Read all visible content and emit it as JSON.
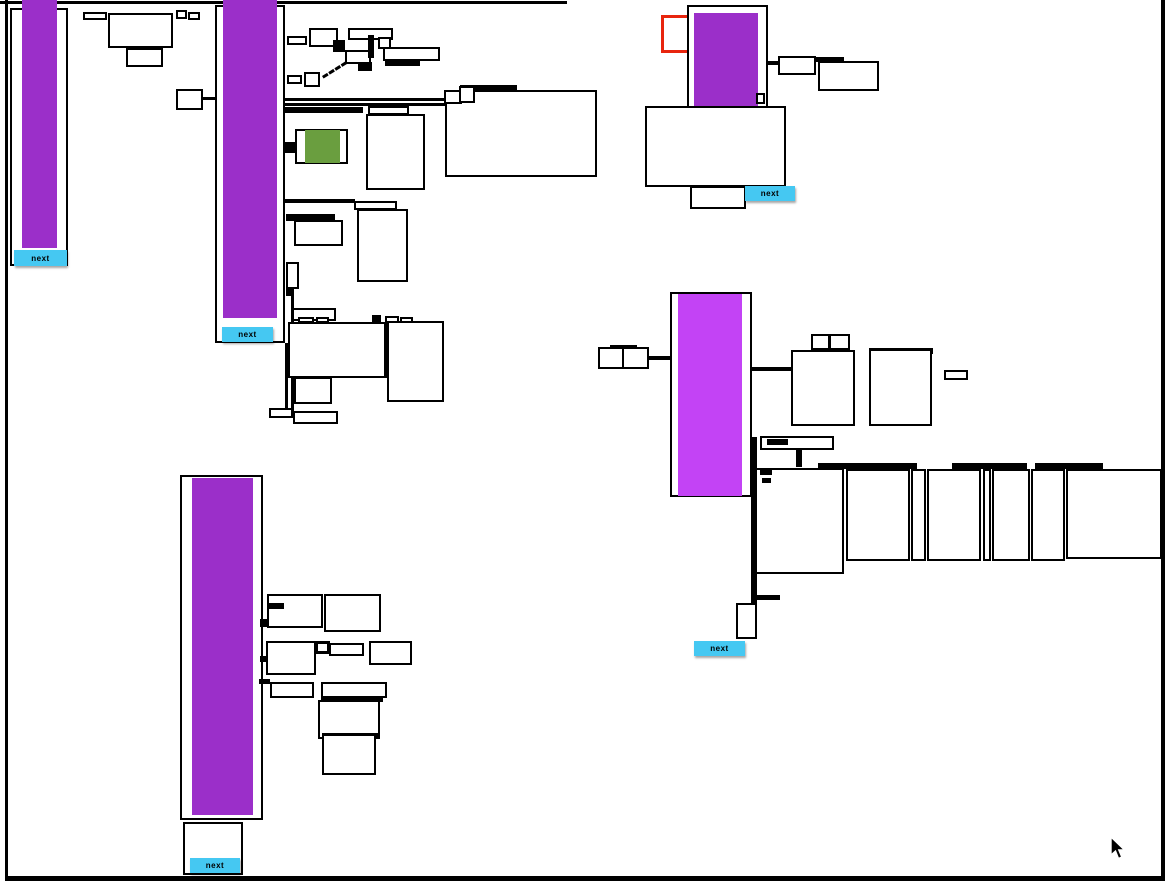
{
  "labels": {
    "next": "next"
  },
  "colors": {
    "purple": "#9b2fc9",
    "magenta": "#c343f5",
    "cyan": "#45c8f2",
    "green": "#6a9e3f",
    "red": "#e8250e",
    "black": "#000000",
    "background": "#ffffff"
  },
  "clusters": [
    {
      "id": "top-left-page",
      "highlight_color": "purple",
      "button": "next"
    },
    {
      "id": "top-middle-page",
      "highlight_color": "purple",
      "button": "next"
    },
    {
      "id": "top-right-page",
      "highlight_color": "purple",
      "button": "next",
      "selection_outline": "red"
    },
    {
      "id": "middle-right-page",
      "highlight_color": "magenta",
      "button": "next"
    },
    {
      "id": "bottom-left-page",
      "highlight_color": "purple",
      "button": "next"
    }
  ],
  "cursor": {
    "x": 1110,
    "y": 838
  }
}
